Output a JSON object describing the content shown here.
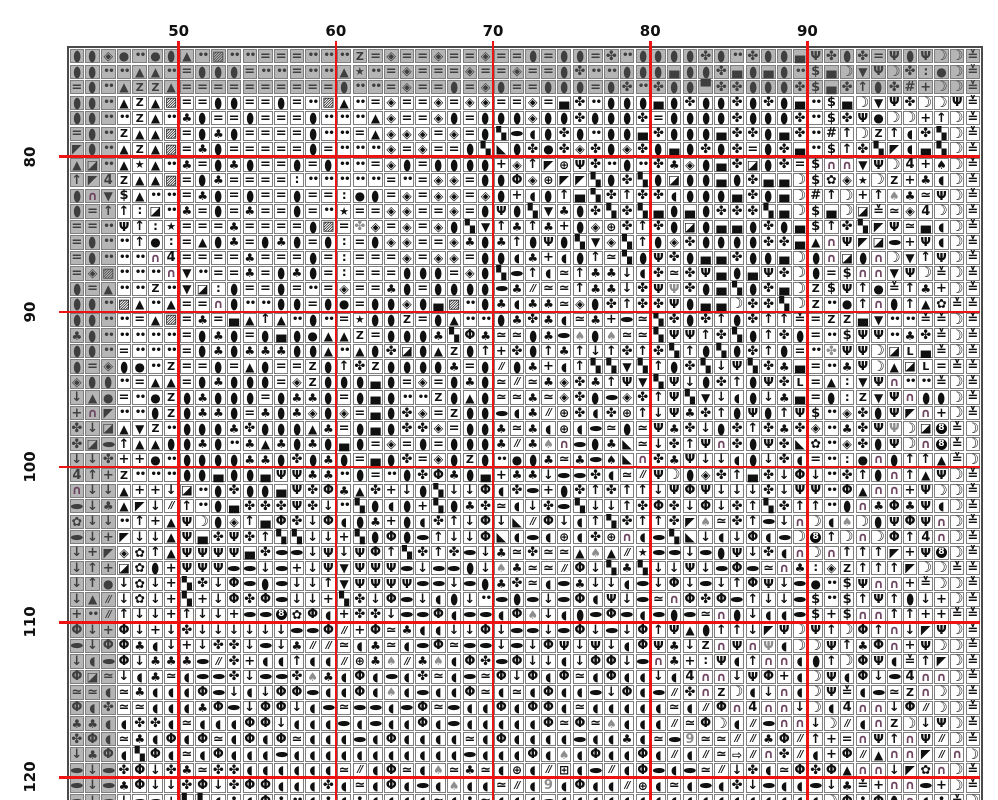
{
  "meta": {
    "description": "Cross-stitch pattern chart page with symbol grid, red 10-stitch gridlines and stitch-count labels",
    "colors": {
      "background": "#ffffff",
      "cell_border": "#7e7e7e",
      "outer_border": "#4b4b4b",
      "gray_fill": "#b5b5b5",
      "major_line": "#ee1313",
      "symbol": "#101010",
      "symbol_gray": "#8e8e8e",
      "arch_symbol": "#6d4560",
      "label": "#101010"
    }
  },
  "grid": {
    "left": 68.6,
    "top": 48,
    "cell_w": 15.72,
    "cell_h": 15.52,
    "cols": 58,
    "rows": 49,
    "gray_top_rows": 3,
    "gray_left_cols": 3
  },
  "axes": {
    "top_labels": [
      {
        "text": "50",
        "col": 7
      },
      {
        "text": "60",
        "col": 17
      },
      {
        "text": "70",
        "col": 27
      },
      {
        "text": "80",
        "col": 37
      },
      {
        "text": "90",
        "col": 47
      }
    ],
    "left_labels": [
      {
        "text": "80",
        "row": 7
      },
      {
        "text": "90",
        "row": 17
      },
      {
        "text": "100",
        "row": 27
      },
      {
        "text": "110",
        "row": 37
      },
      {
        "text": "120",
        "row": 47
      }
    ],
    "major_cols": [
      7,
      17,
      27,
      37,
      47
    ],
    "major_rows": [
      7,
      17,
      27,
      37,
      47
    ]
  },
  "symbol_map": {
    "I": {
      "t": "●",
      "c": "oval"
    },
    "e": {
      "t": "●",
      "c": "leaf"
    },
    "E": {
      "t": "●",
      "c": "leaf graysym"
    },
    "o": {
      "t": "●",
      "c": "blk"
    },
    ".": {
      "t": "••",
      "c": "dots"
    },
    ":": {
      "t": "∶",
      "c": "vdots"
    },
    "=": {
      "t": "=",
      "c": "heavy"
    },
    "Z": {
      "t": "Z",
      "c": "serifz"
    },
    "A": {
      "t": "▲",
      "c": "blk"
    },
    "V": {
      "t": "▼",
      "c": "blk"
    },
    "D": {
      "t": "◈",
      "c": "sq"
    },
    "C": {
      "t": "✤",
      "c": "big"
    },
    "c": {
      "t": "✤",
      "c": "big graysym"
    },
    "H": {
      "t": "▄",
      "c": "big"
    },
    "h": {
      "t": "▀",
      "c": "big"
    },
    "Q": {
      "t": "◪",
      "c": "sq"
    },
    "L": {
      "t": "◣",
      "c": "sq"
    },
    "M": {
      "t": "◤",
      "c": "sq"
    },
    "X": {
      "t": "▨",
      "c": "big"
    },
    "*": {
      "t": "★",
      "c": "star"
    },
    "$": {
      "t": "$",
      "c": "heavy"
    },
    "#": {
      "t": "#",
      "c": "heavy"
    },
    "4": {
      "t": "4",
      "c": "heavy"
    },
    "5": {
      "t": "▚",
      "c": "big"
    },
    "8": {
      "t": "8",
      "c": "circ8"
    },
    "9": {
      "t": "9",
      "c": "heavy graysym"
    },
    "+": {
      "t": "+",
      "c": "heavy"
    },
    "/": {
      "t": "//",
      "c": "slashes"
    },
    "~": {
      "t": "≃",
      "c": "heavy"
    },
    "w": {
      "t": "♣",
      "c": "blk"
    },
    "T": {
      "t": "♠",
      "c": "blk"
    },
    "t": {
      "t": "♠",
      "c": "blk graysym"
    },
    "u": {
      "t": "Ψ",
      "c": "cup"
    },
    "U": {
      "t": "Ψ",
      "c": "cup graysym"
    },
    "(": {
      "t": "◖",
      "c": "blk"
    },
    ")": {
      "t": "☽",
      "c": "moon"
    },
    "n": {
      "t": "∩",
      "c": "arch"
    },
    "F": {
      "t": "Φ",
      "c": "heavy"
    },
    "^": {
      "t": "↑",
      "c": "heavy"
    },
    "!": {
      "t": "↓",
      "c": "heavy"
    },
    "f": {
      "t": "✿",
      "c": "flower"
    },
    "P": {
      "t": "⊕",
      "c": "blk"
    },
    "B": {
      "t": "⊞",
      "c": "blk"
    },
    "G": {
      "t": "⇨",
      "c": "blk"
    },
    "y": {
      "t": "≚",
      "c": "heavy"
    },
    "k": {
      "t": "L",
      "c": "letter"
    }
  },
  "grid_rows": [
    "IIDo.oIA.X..===...Z=D==D==D==I=II=C.IIIICI.CIIHuCIC=uIu))y",
    "II..AA.=III=..=..A*.=D===D==D==IC..IIIHIICHIHI.$H)Vu)C:o)y",
    "=I.AZZA==========I..=D==I=DI==III=IC.CIIhCCIIIC$HC^IC#+))y",
    "II.AZAX==II==I=.XA.=D==D=DD==D=HC.IIIHICIICICIH.$H)VuC))uy",
    "II..ZA.wI==I===I...AD==DI=IIIDIICIIIC=IIIICIIIC.$Cuo))+^)y",
    "=I.ZAAX=IwI====I..=ADDD=D=I5e(ICI.IIHCIIIHCCIHC.#^)Z^(C5)y",
    "MI.AZAX=wI=====I=...D=D==I5LICoCDCIDCIHICIC=ICH.$^C5M(H5)y",
    "AQ.A*A.w=IwI==I=I..=DI=IIII+D^MPuC.I.CwDIHCQIC=$nnVu)4+T)y",
    "^M4ZAAX=Iw====:.....=.=DD=IIFDPMM5IC5IQIIHICHH)$fD*)Z+w()y",
    "InV$A..=wI=I==I==:oI=D=DD=DI+(I^H5C^CC(IIIHCIH)#^)+^tw~u)y",
    "I=^^:Q.w=I=w==I=.*==DD==D=IuI5VwIC5C5HIHICCC5H)$H)Qy~D4))y",
    "==.u^:*===w====IX=cD=D=DI5V^w^w+IDPC^CIQIHHICIH$^C5Mu~H()y",
    "=I..^o:=AIw=IwI=I:=IDD==DwIw^IuI5VD5^IDCIIIICCHAnuMQe+u()y",
    "=I...n4====w===I=:===D=DD=II(w+(I^~5IuCIHHCIIH)InQIn)V^u)y",
    "=DX...nV.==w=IwI=:===III=DI5e^(~^ww!(C~CuHIHuC)I=$nnVu)y)y",
    "I=A..Z.VQ:I==I=.=D==wI=IIIIew/~~^ww!CuUCIH5ICH)Z$u^oy^w+)y",
    "II.XA.A==nI..II=Io=IIDIHX.Iw(ww~DIC^CCuIHH)CC5)Z.o^nI^Afyy",
    "II..=AX=w=HA^A.I.=*IIZ=IA..IwCw(~w+e~5CIC^IC^^y=ZZHV..yy)y",
    "wI.....=IwI=IHIoAAZ=IIIw5Fw~~IwetIt~~5uu^C5I^CI=.$uu.wCy)y",
    "II.=...=IwIwwwIIA.AICQIAZI^+CI^w^!^C^C5^I5IC^I=.cuu)QkHy)y",
    "I=DIo.Z==I=AI==ZI^CZIIIIw=I/Iw+(^55V5^IC5!u5CwH=.wu)AQk=yy",
    "DII.=AA=IwIII=DZIIIHI=D=IwI~/~wDCw^uV5u!IC^IuCk=A:Vun..y)y",
    "!Ao=.oZIwIII=IwwI=IHI..ZIAI~~w~DCIeDC^u5V!(I!wH=I:ZVunII)y",
    "+nM..IZIwwI=wIwDID=HICD=ZIIe(w/PC(CP^!uwC^IuI^u$.DCIuMn+)y",
    "C!QAVZ.IIIwCIIIAw=IHICCD=IIw~w(P(e~I~uwC!IC^CwCD.wCuU)Q8y)",
    "CQe^AAIIwI.wAwIwIHI=D=I=IIIw/wtneIwL~!C^unCIuCLf.DCIu)n8y)",
    "!!C++o.IIIIwwICIwI=HIC=DIZI.oIw~weTLnCwu!!(I!C(=.:onI^^Ay)",
    "4^+Z...IIHIIHuuww.I=.ICFwIH+ww!eeC(~/u)IDC^HC!F!.C^In^Au)y",
    "n!!A++!Q.ICIIHuCFwAC+!I5!!F(Ce+IC^C^^!uFu!!!C!uu.FAnn+u))y",
    "e!wAM!/^.IHCCCuC!.5I(I+5IwC~(!Ce5!!^CFC!F!C^5C^^.InwFwu()y",
    "f!!.^+Au)ID^HFC!F(Iw+I(C^!F!L/F!(^5C^^CMt~C^e!n)(t)IuFun)y",
    "e!+M!!AuHCuC^55!!+5IFIe^!!FL(e(P(CPn(e5L!(!F(e)8^)n)F^4n)y",
    "!+MDf^AuuuuHCee!u!uF^5C^Ce!w~C~~AtA/*ee!eIu!C(n)n^^^M+u8)y",
    "!^+QfI+uuuee!e+!uVuuue!eeI!tw~~/F!5w5!!u!eFe~nw:DZ^^^M))yy",
    "!^o!f!+5C!FeIe!!^Vuuuuee!eIwC~(ew!!(e!F!e!^Fu!eo.$unn+y))y",
    "!A/!f!+5+!FCFe!!+5C!Fe!(I!.eIe!eF(u!e~nFCFe^!!e$.$^u^I!+)y",
    "+./^!!+^!!+ee8fF(+CC!eeF(ee(Ft!(IeFe(eIe~nI!((e$+$nn^^++yy",
    "F!+F!+!C!!!!!!eeF/+F~w((!!F!ee!eF!e!F^uAI^^!Mu)u^)F^n!Mu)y",
    "e!FFw(!+!CC!e!w//~(w~(eF~ee!e!Fu!u!(Fuw!ZnunU())u^wFn+u))y",
    "!(eF!wwwe/C+((^((/Pwt/wt(FCeF!!(!FF!enw+:u(^nn(I^)Fu(y^M)y",
    "FQ~!(w~(eeC!eeCtw(F(e(C~(e~F!F(F~(F((!(4nn!uF+()u(F!e4nn)y",
    "~~(~w(((Fe!(!FFe((F(t(e((F~(~(F((e!F(e/CnZ)(!n()uy(e~Zn))y",
    "F(C~~(((wFe!FF!(e~ee(eF~e((F(FF(~(((((~(/Fn4nn!)(4nn!F/))y",
    "ww((CC(~(((FF!(((e(e((F(e(((((F~F~t(((/~F)(/enn!)/(nZ)!u)y",
    "CF(~w(F(F~(F(F~(((e(F((((~(F((((e((w(~e9~~//wF/^+=nu^nu/)y",
    "!wF(5F(~(F(((e(((((((((((e(((F(t(F((F(/(/~G/nC/(+F/AnnM/n)y",
    "e!eCF!Cw~CC((((((~/(F~(t~w~(P(/B(e/(Fe(e~/!C(~FCFAnn!Mfn)y",
    "e!ewF!!CF!CFF(((C(~(F(e(t((~/(9(F((/P(~(e(C!e((e!wy+nne+)y",
    "e!e!ee+55(w(Fw.(w(w((((~(w~(((e((((((((((((((((()FwFIn(wy)y"
  ]
}
